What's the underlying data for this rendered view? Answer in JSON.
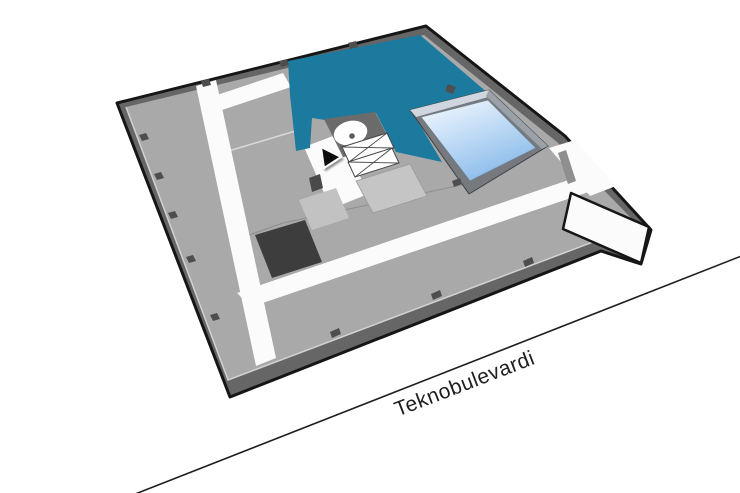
{
  "title": "3D indoor map floor view",
  "street": {
    "label": "Teknobulevardi"
  },
  "map": {
    "symbols": [
      "location-marker-icon",
      "spiral-stair-icon",
      "staircase-icon",
      "skylight-atrium",
      "highlighted-room"
    ]
  },
  "colors": {
    "bg": "#ffffff",
    "outline": "#161616",
    "wall": "#666666",
    "floor": "#a9a9a9",
    "corridor": "#fbfbfb",
    "highlight": "#1c7a9e",
    "room_dark": "#3d3d3d",
    "room_light": "#c5c5c5",
    "room_light2": "#c2c2c2",
    "core": "#6b6b6b",
    "circle_dot": "#5a5a5a",
    "stair_outline": "#4a4a4a",
    "stub": "#4e4e4e",
    "block": "#4a4a4a",
    "rod": "#8f8f8f",
    "divider": "#8f8f8f",
    "curb": "#d9d9d9",
    "sky_wall": "#76797e",
    "sky_lip_nw": "#cfd6df",
    "sky_lip_ne": "#9aa1a9",
    "sky_from": "#f3f8fe",
    "sky_mid": "#c2dcf6",
    "sky_to": "#86b9e9",
    "glass_edge": "#6f7e8c",
    "street": "#1f1f1f",
    "marker": "#0b0b0b"
  }
}
